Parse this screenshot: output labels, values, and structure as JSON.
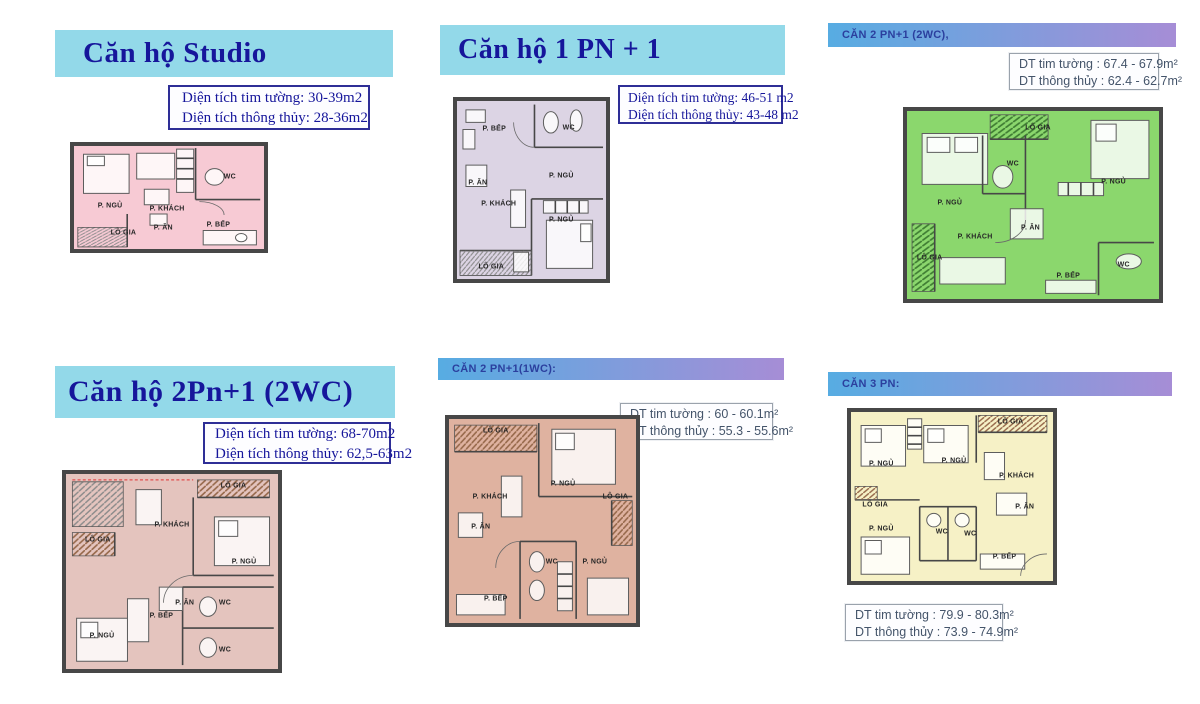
{
  "theme": {
    "banner_cyan": "#93d9e9",
    "banner_grad_from": "#57ace2",
    "banner_grad_to": "#a68dd6",
    "title_navy": "#16169b",
    "grad_title_blue": "#2b3f9e",
    "info_navy_border": "#2e2e96",
    "info_gray_border": "#9aa2ac",
    "info_gray_text": "#44546a",
    "wall": "#474747"
  },
  "panels": [
    {
      "id": "studio",
      "title": "Căn hộ Studio",
      "info_lines": [
        "Diện tích tim tường: 30-39m2",
        "Diện tích thông thủy: 28-36m2"
      ],
      "plan_color": "#f7cad4",
      "rooms": [
        {
          "label": "P. NGỦ",
          "x": 19,
          "y": 58
        },
        {
          "label": "P. KHÁCH",
          "x": 49,
          "y": 61
        },
        {
          "label": "WC",
          "x": 82,
          "y": 30
        },
        {
          "label": "LÔ GIA",
          "x": 26,
          "y": 84
        },
        {
          "label": "P. ĂN",
          "x": 47,
          "y": 80
        },
        {
          "label": "P. BẾP",
          "x": 76,
          "y": 77
        }
      ]
    },
    {
      "id": "1pn-1",
      "title": "Căn hộ 1 PN + 1",
      "info_lines": [
        "Diện tích tim tường: 46-51 m2",
        "Diện tích thông thủy: 43-48 m2"
      ],
      "plan_color": "#dcd4e4",
      "rooms": [
        {
          "label": "P. BẾP",
          "x": 25,
          "y": 16
        },
        {
          "label": "WC",
          "x": 75,
          "y": 15
        },
        {
          "label": "P. ĂN",
          "x": 14,
          "y": 46
        },
        {
          "label": "P. NGỦ",
          "x": 70,
          "y": 42
        },
        {
          "label": "P. KHÁCH",
          "x": 28,
          "y": 58
        },
        {
          "label": "P. NGỦ",
          "x": 70,
          "y": 67
        },
        {
          "label": "LÔ GIA",
          "x": 23,
          "y": 93
        }
      ]
    },
    {
      "id": "2pn1-2wc-right",
      "title": "CĂN 2 PN+1 (2WC),",
      "info_lines": [
        "DT tim tường  : 67.4 - 67.9m²",
        "DT thông thủy : 62.4 - 62.7m²"
      ],
      "plan_color": "#8bd76d",
      "rooms": [
        {
          "label": "LÔ GIA",
          "x": 52,
          "y": 9
        },
        {
          "label": "WC",
          "x": 42,
          "y": 28
        },
        {
          "label": "P. NGỦ",
          "x": 17,
          "y": 49
        },
        {
          "label": "P. NGỦ",
          "x": 82,
          "y": 38
        },
        {
          "label": "P. KHÁCH",
          "x": 27,
          "y": 67
        },
        {
          "label": "P. ĂN",
          "x": 49,
          "y": 62
        },
        {
          "label": "LÔ GIA",
          "x": 9,
          "y": 78
        },
        {
          "label": "P. BẾP",
          "x": 64,
          "y": 88
        },
        {
          "label": "WC",
          "x": 86,
          "y": 82
        }
      ]
    },
    {
      "id": "2pn1-2wc-left",
      "title": "Căn hộ 2Pn+1 (2WC)",
      "info_lines": [
        "Diện tích tim tường: 68-70m2",
        "Diện tích thông thủy: 62,5-63m2"
      ],
      "plan_color": "#e4c4be",
      "rooms": [
        {
          "label": "P. KHÁCH",
          "x": 50,
          "y": 26
        },
        {
          "label": "LÔ GIA",
          "x": 79,
          "y": 6
        },
        {
          "label": "P. NGỦ",
          "x": 84,
          "y": 45
        },
        {
          "label": "LÔ GIA",
          "x": 15,
          "y": 34
        },
        {
          "label": "P. ĂN",
          "x": 56,
          "y": 66
        },
        {
          "label": "P. BẾP",
          "x": 45,
          "y": 73
        },
        {
          "label": "WC",
          "x": 75,
          "y": 66
        },
        {
          "label": "WC",
          "x": 75,
          "y": 90
        },
        {
          "label": "P. NGỦ",
          "x": 17,
          "y": 83
        }
      ]
    },
    {
      "id": "2pn1-1wc",
      "title": "CĂN 2 PN+1(1WC):",
      "info_lines": [
        "DT tim tường  : 60 - 60.1m²",
        "DT thông thủy : 55.3 - 55.6m²"
      ],
      "plan_color": "#dfb2a0",
      "rooms": [
        {
          "label": "LÔ GIA",
          "x": 25,
          "y": 6
        },
        {
          "label": "P. NGỦ",
          "x": 61,
          "y": 32
        },
        {
          "label": "P. KHÁCH",
          "x": 22,
          "y": 38
        },
        {
          "label": "LÔ GIA",
          "x": 89,
          "y": 38
        },
        {
          "label": "P. ĂN",
          "x": 17,
          "y": 53
        },
        {
          "label": "WC",
          "x": 55,
          "y": 70
        },
        {
          "label": "P. NGỦ",
          "x": 78,
          "y": 70
        },
        {
          "label": "P. BẾP",
          "x": 25,
          "y": 88
        }
      ]
    },
    {
      "id": "3pn",
      "title": "CĂN 3 PN:",
      "info_lines": [
        "DT tim tường  : 79.9 - 80.3m²",
        "DT thông thủy : 73.9 - 74.9m²"
      ],
      "plan_color": "#f6f1c6",
      "rooms": [
        {
          "label": "P. NGỦ",
          "x": 15,
          "y": 31
        },
        {
          "label": "P. NGỦ",
          "x": 51,
          "y": 29
        },
        {
          "label": "LÔ GIA",
          "x": 79,
          "y": 6
        },
        {
          "label": "P. KHÁCH",
          "x": 82,
          "y": 38
        },
        {
          "label": "P. ĂN",
          "x": 86,
          "y": 56
        },
        {
          "label": "LÔ GIA",
          "x": 12,
          "y": 55
        },
        {
          "label": "P. NGỦ",
          "x": 15,
          "y": 69
        },
        {
          "label": "WC",
          "x": 45,
          "y": 71
        },
        {
          "label": "WC",
          "x": 59,
          "y": 72
        },
        {
          "label": "P. BẾP",
          "x": 76,
          "y": 86
        }
      ]
    }
  ]
}
